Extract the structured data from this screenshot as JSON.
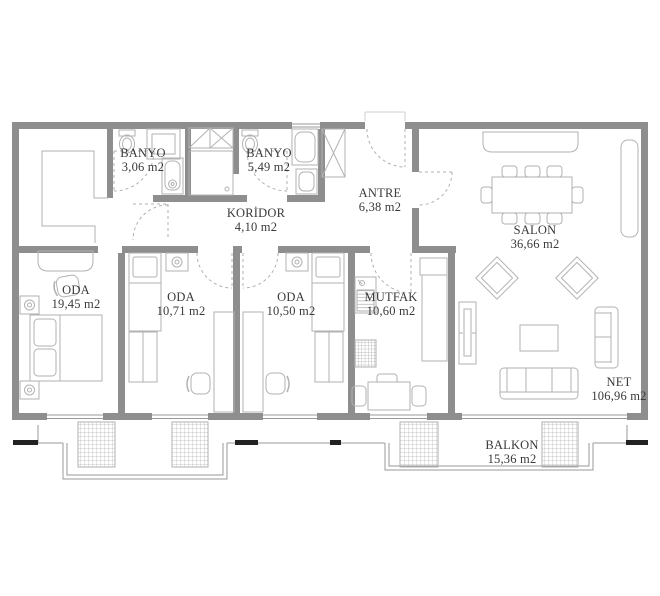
{
  "plan": {
    "title": "apartment-floor-plan",
    "colors": {
      "wall_gray": "#8e8e8e",
      "text": "#3a3a3a"
    },
    "rooms": [
      {
        "id": "banyo-1",
        "name": "BANYO",
        "area": "3,06 m2"
      },
      {
        "id": "banyo-2",
        "name": "BANYO",
        "area": "5,49 m2"
      },
      {
        "id": "koridor",
        "name": "KORİDOR",
        "area": "4,10 m2"
      },
      {
        "id": "antre",
        "name": "ANTRE",
        "area": "6,38 m2"
      },
      {
        "id": "salon",
        "name": "SALON",
        "area": "36,66 m2"
      },
      {
        "id": "oda-1",
        "name": "ODA",
        "area": "19,45 m2"
      },
      {
        "id": "oda-2",
        "name": "ODA",
        "area": "10,71 m2"
      },
      {
        "id": "oda-3",
        "name": "ODA",
        "area": "10,50 m2"
      },
      {
        "id": "mutfak",
        "name": "MUTFAK",
        "area": "10,60 m2"
      },
      {
        "id": "net",
        "name": "NET",
        "area": "106,96 m2"
      },
      {
        "id": "balkon",
        "name": "BALKON",
        "area": "15,36 m2"
      }
    ]
  }
}
